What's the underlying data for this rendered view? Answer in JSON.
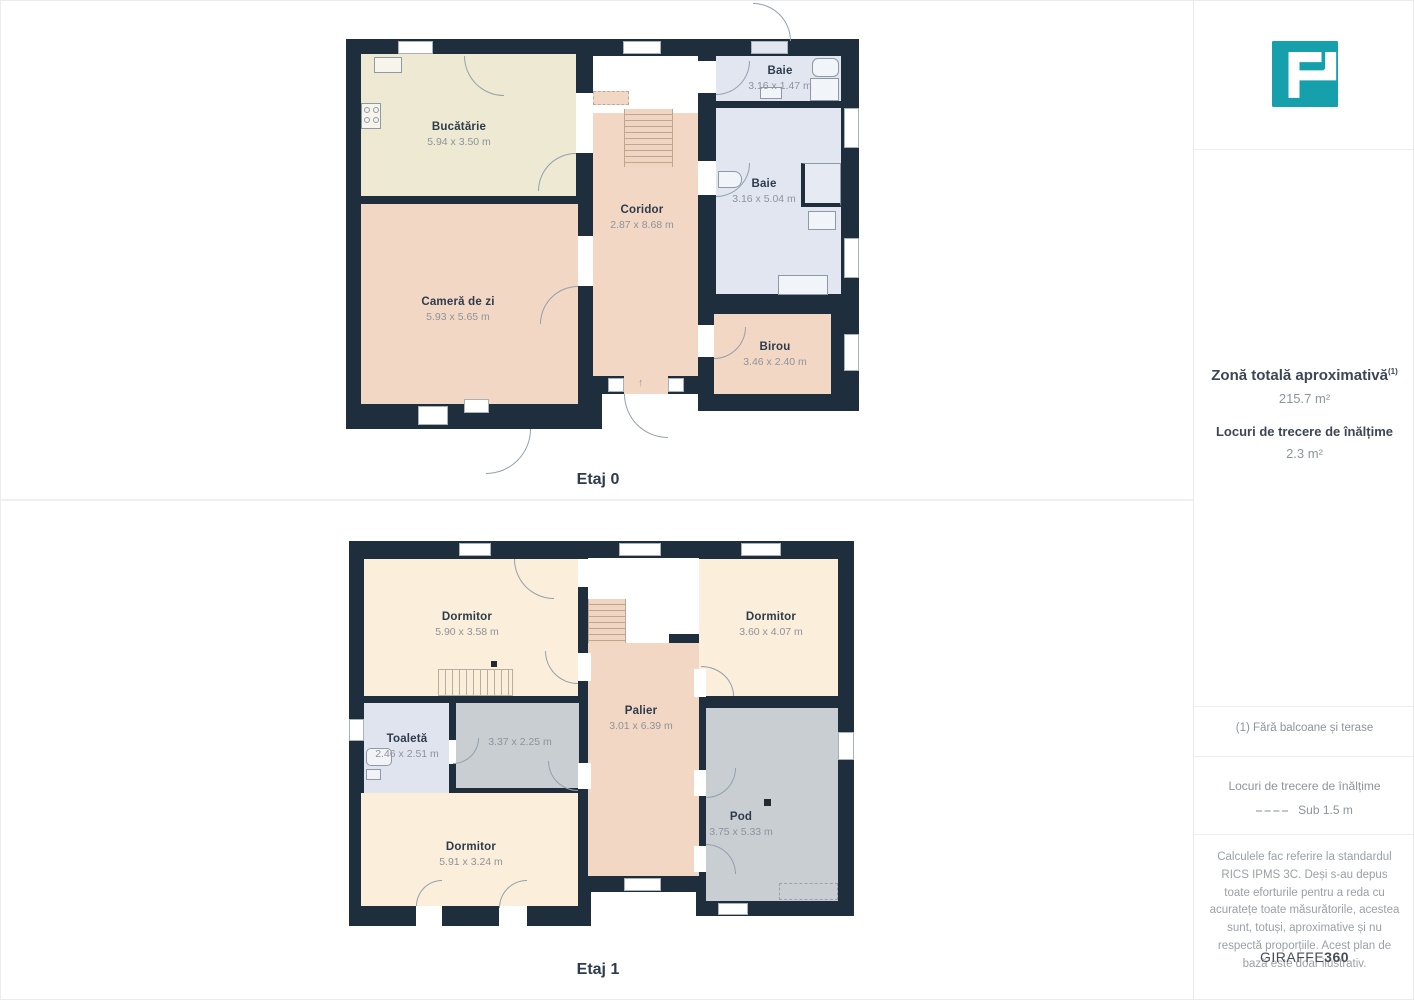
{
  "floors": [
    {
      "label": "Etaj 0",
      "rooms": [
        {
          "name": "Bucătărie",
          "dims": "5.94 x 3.50 m"
        },
        {
          "name": "Cameră de zi",
          "dims": "5.93 x 5.65 m"
        },
        {
          "name": "Coridor",
          "dims": "2.87 x 8.68 m"
        },
        {
          "name": "Baie",
          "dims": "3.16 x 1.47 m"
        },
        {
          "name": "Baie",
          "dims": "3.16 x 5.04 m"
        },
        {
          "name": "Birou",
          "dims": "3.46 x 2.40 m"
        }
      ]
    },
    {
      "label": "Etaj 1",
      "rooms": [
        {
          "name": "Dormitor",
          "dims": "5.90 x 3.58 m"
        },
        {
          "name": "Dormitor",
          "dims": "3.60 x 4.07 m"
        },
        {
          "name": "Toaletă",
          "dims": "2.46 x 2.51 m"
        },
        {
          "name": "",
          "dims": "3.37 x 2.25 m"
        },
        {
          "name": "Palier",
          "dims": "3.01 x 6.39 m"
        },
        {
          "name": "Pod",
          "dims": "3.75 x 5.33 m"
        },
        {
          "name": "Dormitor",
          "dims": "5.91 x 3.24 m"
        }
      ]
    }
  ],
  "sidebar": {
    "total_area_label": "Zonă totală aproximativă",
    "total_area_sup": "(1)",
    "total_area_value": "215.7 m²",
    "headroom_label": "Locuri de trecere de înălțime",
    "headroom_value": "2.3 m²",
    "footnote": "(1) Fără balcoane și terase",
    "legend_title": "Locuri de trecere de înălțime",
    "legend_value": "Sub 1.5 m",
    "disclaimer": "Calculele fac referire la standardul RICS IPMS 3C. Deși s-au depus toate eforturile pentru a reda cu acuratețe toate măsurătorile, acestea sunt, totuși, aproximative și nu respectă proporțiile. Acest plan de bază este doar ilustrativ.",
    "brand_regular": "GIRAFFE",
    "brand_bold": "360"
  },
  "misc": {
    "stairs_arrow": "↑"
  },
  "colors": {
    "accent": "#16a0ab",
    "wall": "#1f2e3c",
    "floor_warm": "#f2d7c4",
    "floor_cream": "#ede9d2",
    "floor_bedroom": "#fbeeda",
    "floor_bath": "#e1e6f0",
    "floor_toilet": "#dfe4ee",
    "floor_gray": "#c9ced3"
  }
}
